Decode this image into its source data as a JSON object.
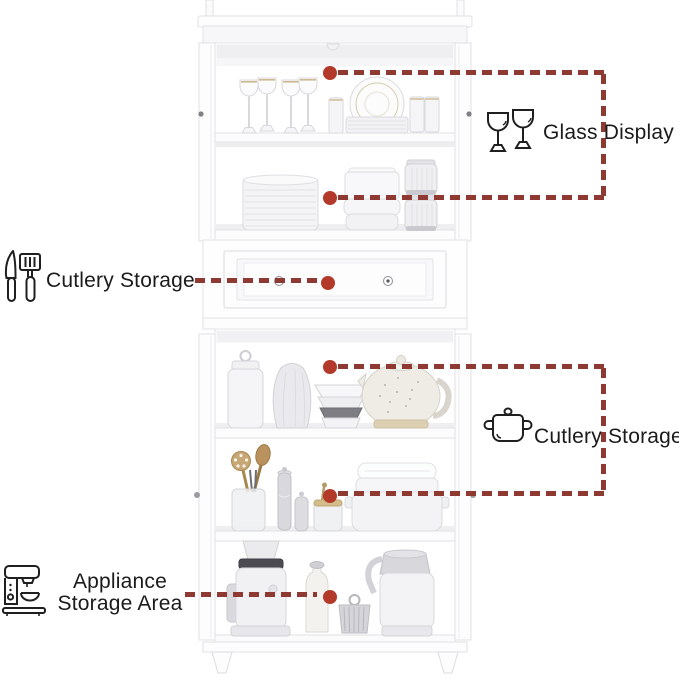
{
  "colors": {
    "dash": "#8e3a33",
    "dot": "#b33a2b",
    "label_text": "#1b1b1b"
  },
  "annotations": {
    "glass_display": {
      "label": "Glass Display",
      "icon": "wine-glasses-icon"
    },
    "cutlery_drawer": {
      "label": "Cutlery Storage",
      "icon": "cutlery-icon"
    },
    "cutlery_cabinet": {
      "label": "Cutlery Storage",
      "icon": "pot-icon"
    },
    "appliance_area": {
      "label_line1": "Appliance",
      "label_line2": "Storage Area",
      "icon": "coffee-machine-icon"
    }
  }
}
